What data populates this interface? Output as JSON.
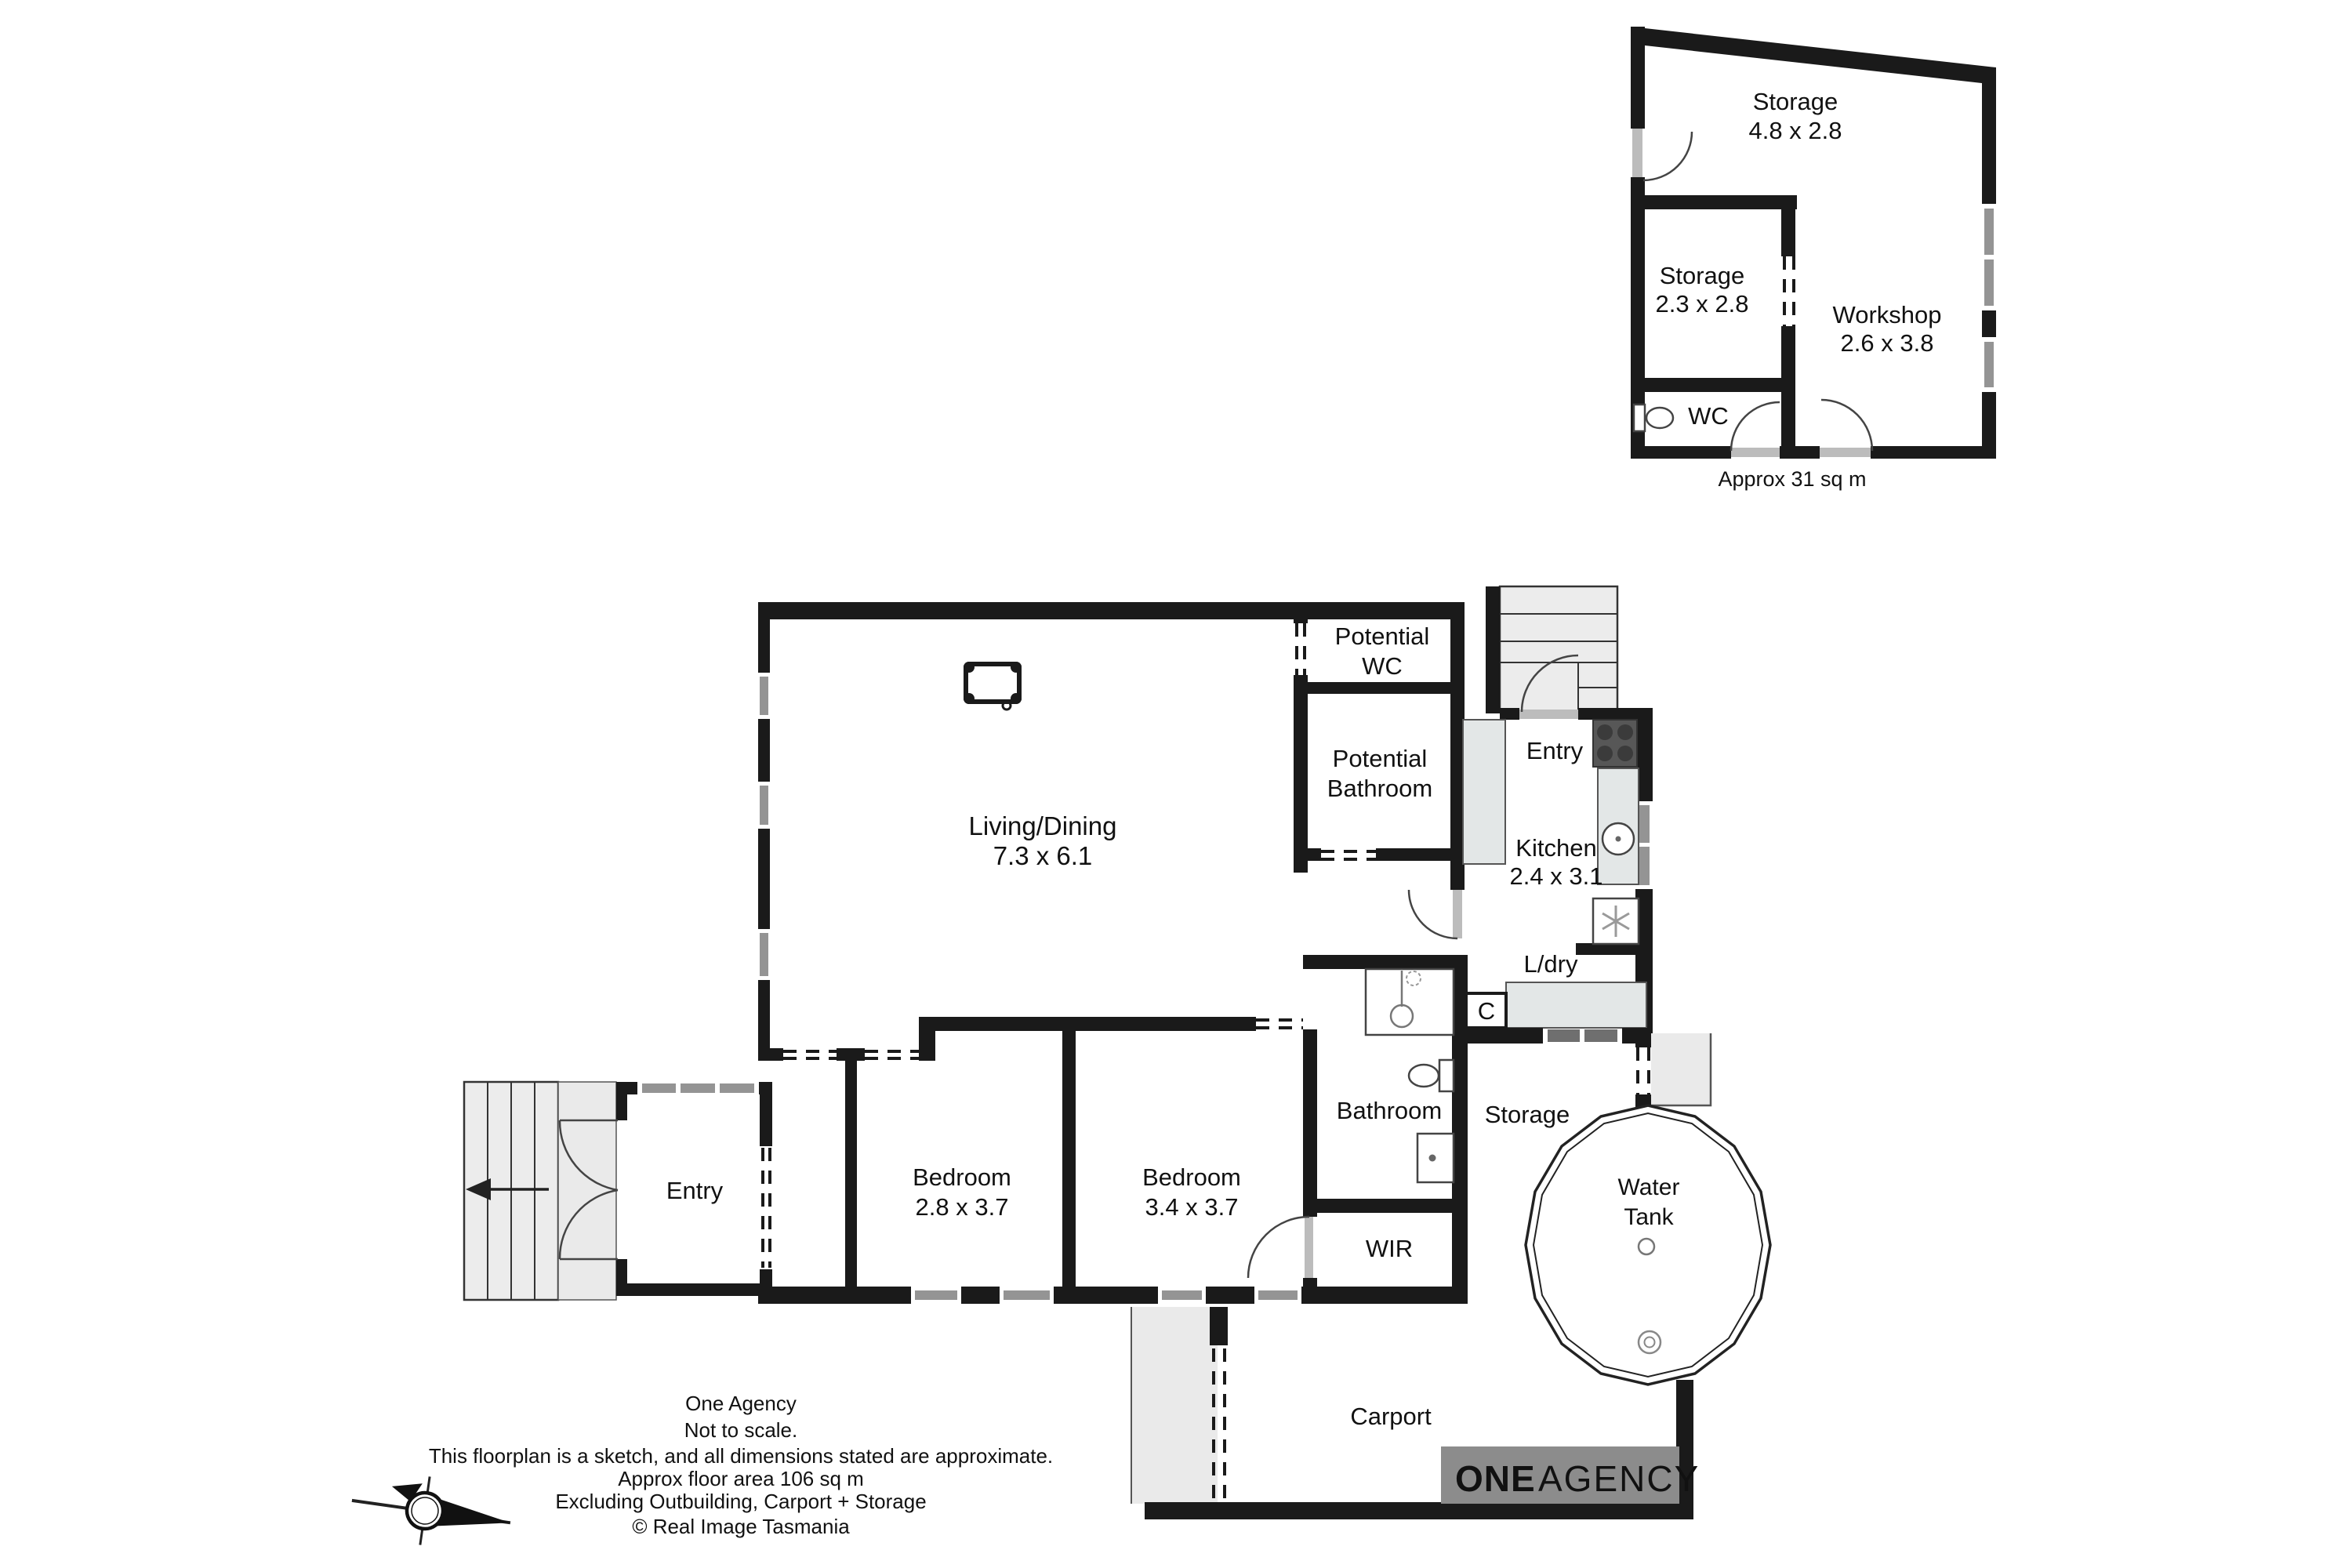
{
  "colors": {
    "wall": "#1a1a1a",
    "window": "#949494",
    "window_dark": "#6f6f6f",
    "external_gray": "#eaeaea",
    "bench_gray": "#e3e7e7",
    "stove_gray": "#575757",
    "logo_background": "#8c8c8c",
    "logo_one": "#f6bb92",
    "logo_agency": "#ffffff"
  },
  "house": {
    "living": {
      "name": "Living/Dining",
      "dims": "7.3 x 6.1"
    },
    "potential_wc": {
      "line1": "Potential",
      "line2": "WC"
    },
    "potential_bathroom": {
      "line1": "Potential",
      "line2": "Bathroom"
    },
    "entry_back": "Entry",
    "kitchen": {
      "name": "Kitchen",
      "dims": "2.4 x 3.1"
    },
    "laundry": "L/dry",
    "cupboard": "C",
    "bathroom": "Bathroom",
    "storage": "Storage",
    "wir": "WIR",
    "bedroom1": {
      "name": "Bedroom",
      "dims": "2.8 x 3.7"
    },
    "bedroom2": {
      "name": "Bedroom",
      "dims": "3.4 x 3.7"
    },
    "entry_front": "Entry",
    "water_tank": {
      "line1": "Water",
      "line2": "Tank"
    },
    "carport": "Carport"
  },
  "outbuilding": {
    "storage_main": {
      "name": "Storage",
      "dims": "4.8 x 2.8"
    },
    "storage_small": {
      "name": "Storage",
      "dims": "2.3 x 2.8"
    },
    "workshop": {
      "name": "Workshop",
      "dims": "2.6 x 3.8"
    },
    "wc": "WC",
    "area_note": "Approx 31 sq m"
  },
  "footer": {
    "lines": [
      "One Agency",
      "Not to scale.",
      "This floorplan is a sketch, and all dimensions stated are approximate.",
      "Approx  floor area 106 sq m",
      "Excluding Outbuilding, Carport + Storage",
      "© Real Image Tasmania"
    ]
  },
  "logo": {
    "one": "ONE",
    "agency": "AGENCY"
  },
  "compass": {
    "north": "N"
  }
}
